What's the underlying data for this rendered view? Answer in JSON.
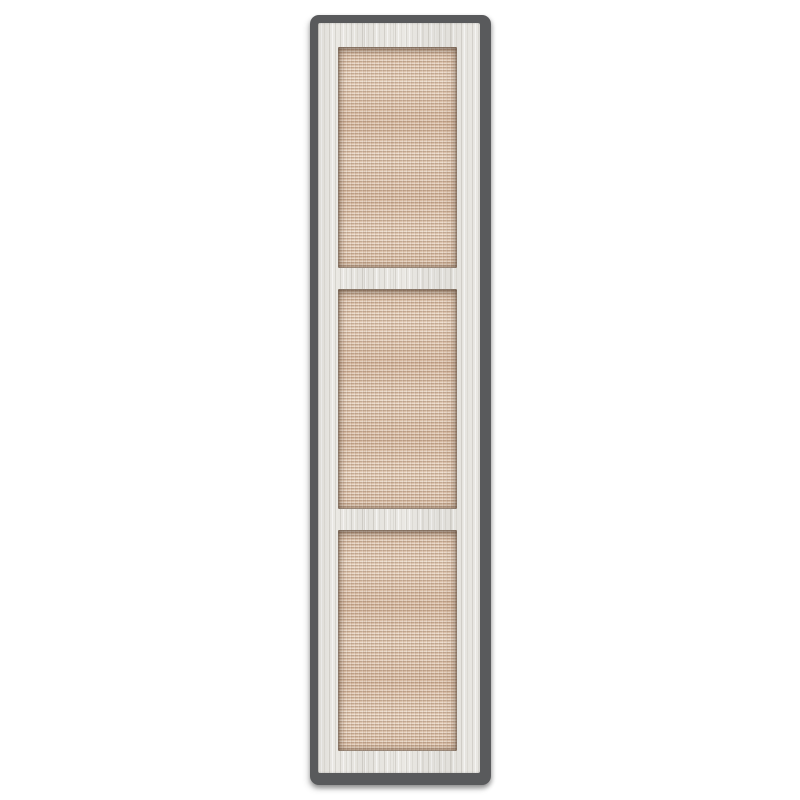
{
  "scene": {
    "type": "product-image",
    "description": "Tall rectangular cabinet door shown upright on a plain white background; dark gray edge outline, whitewashed wood frame with vertical grain, three equal inset woven rattan cane panels separated by horizontal rails",
    "text_content": "none"
  },
  "door": {
    "panel_count": 3,
    "frame_material": "whitewashed wood with vertical grain",
    "panel_material": "woven rattan cane webbing",
    "orientation": "vertical"
  },
  "colors": {
    "background": "#ffffff",
    "edge": "#595a5c",
    "frame": "#e9e7e2",
    "frame-grain": "#b8b4ab",
    "rattan": "#d9bfa8",
    "rattan-light": "#eedcc8",
    "rattan-dark": "#8a6950"
  }
}
